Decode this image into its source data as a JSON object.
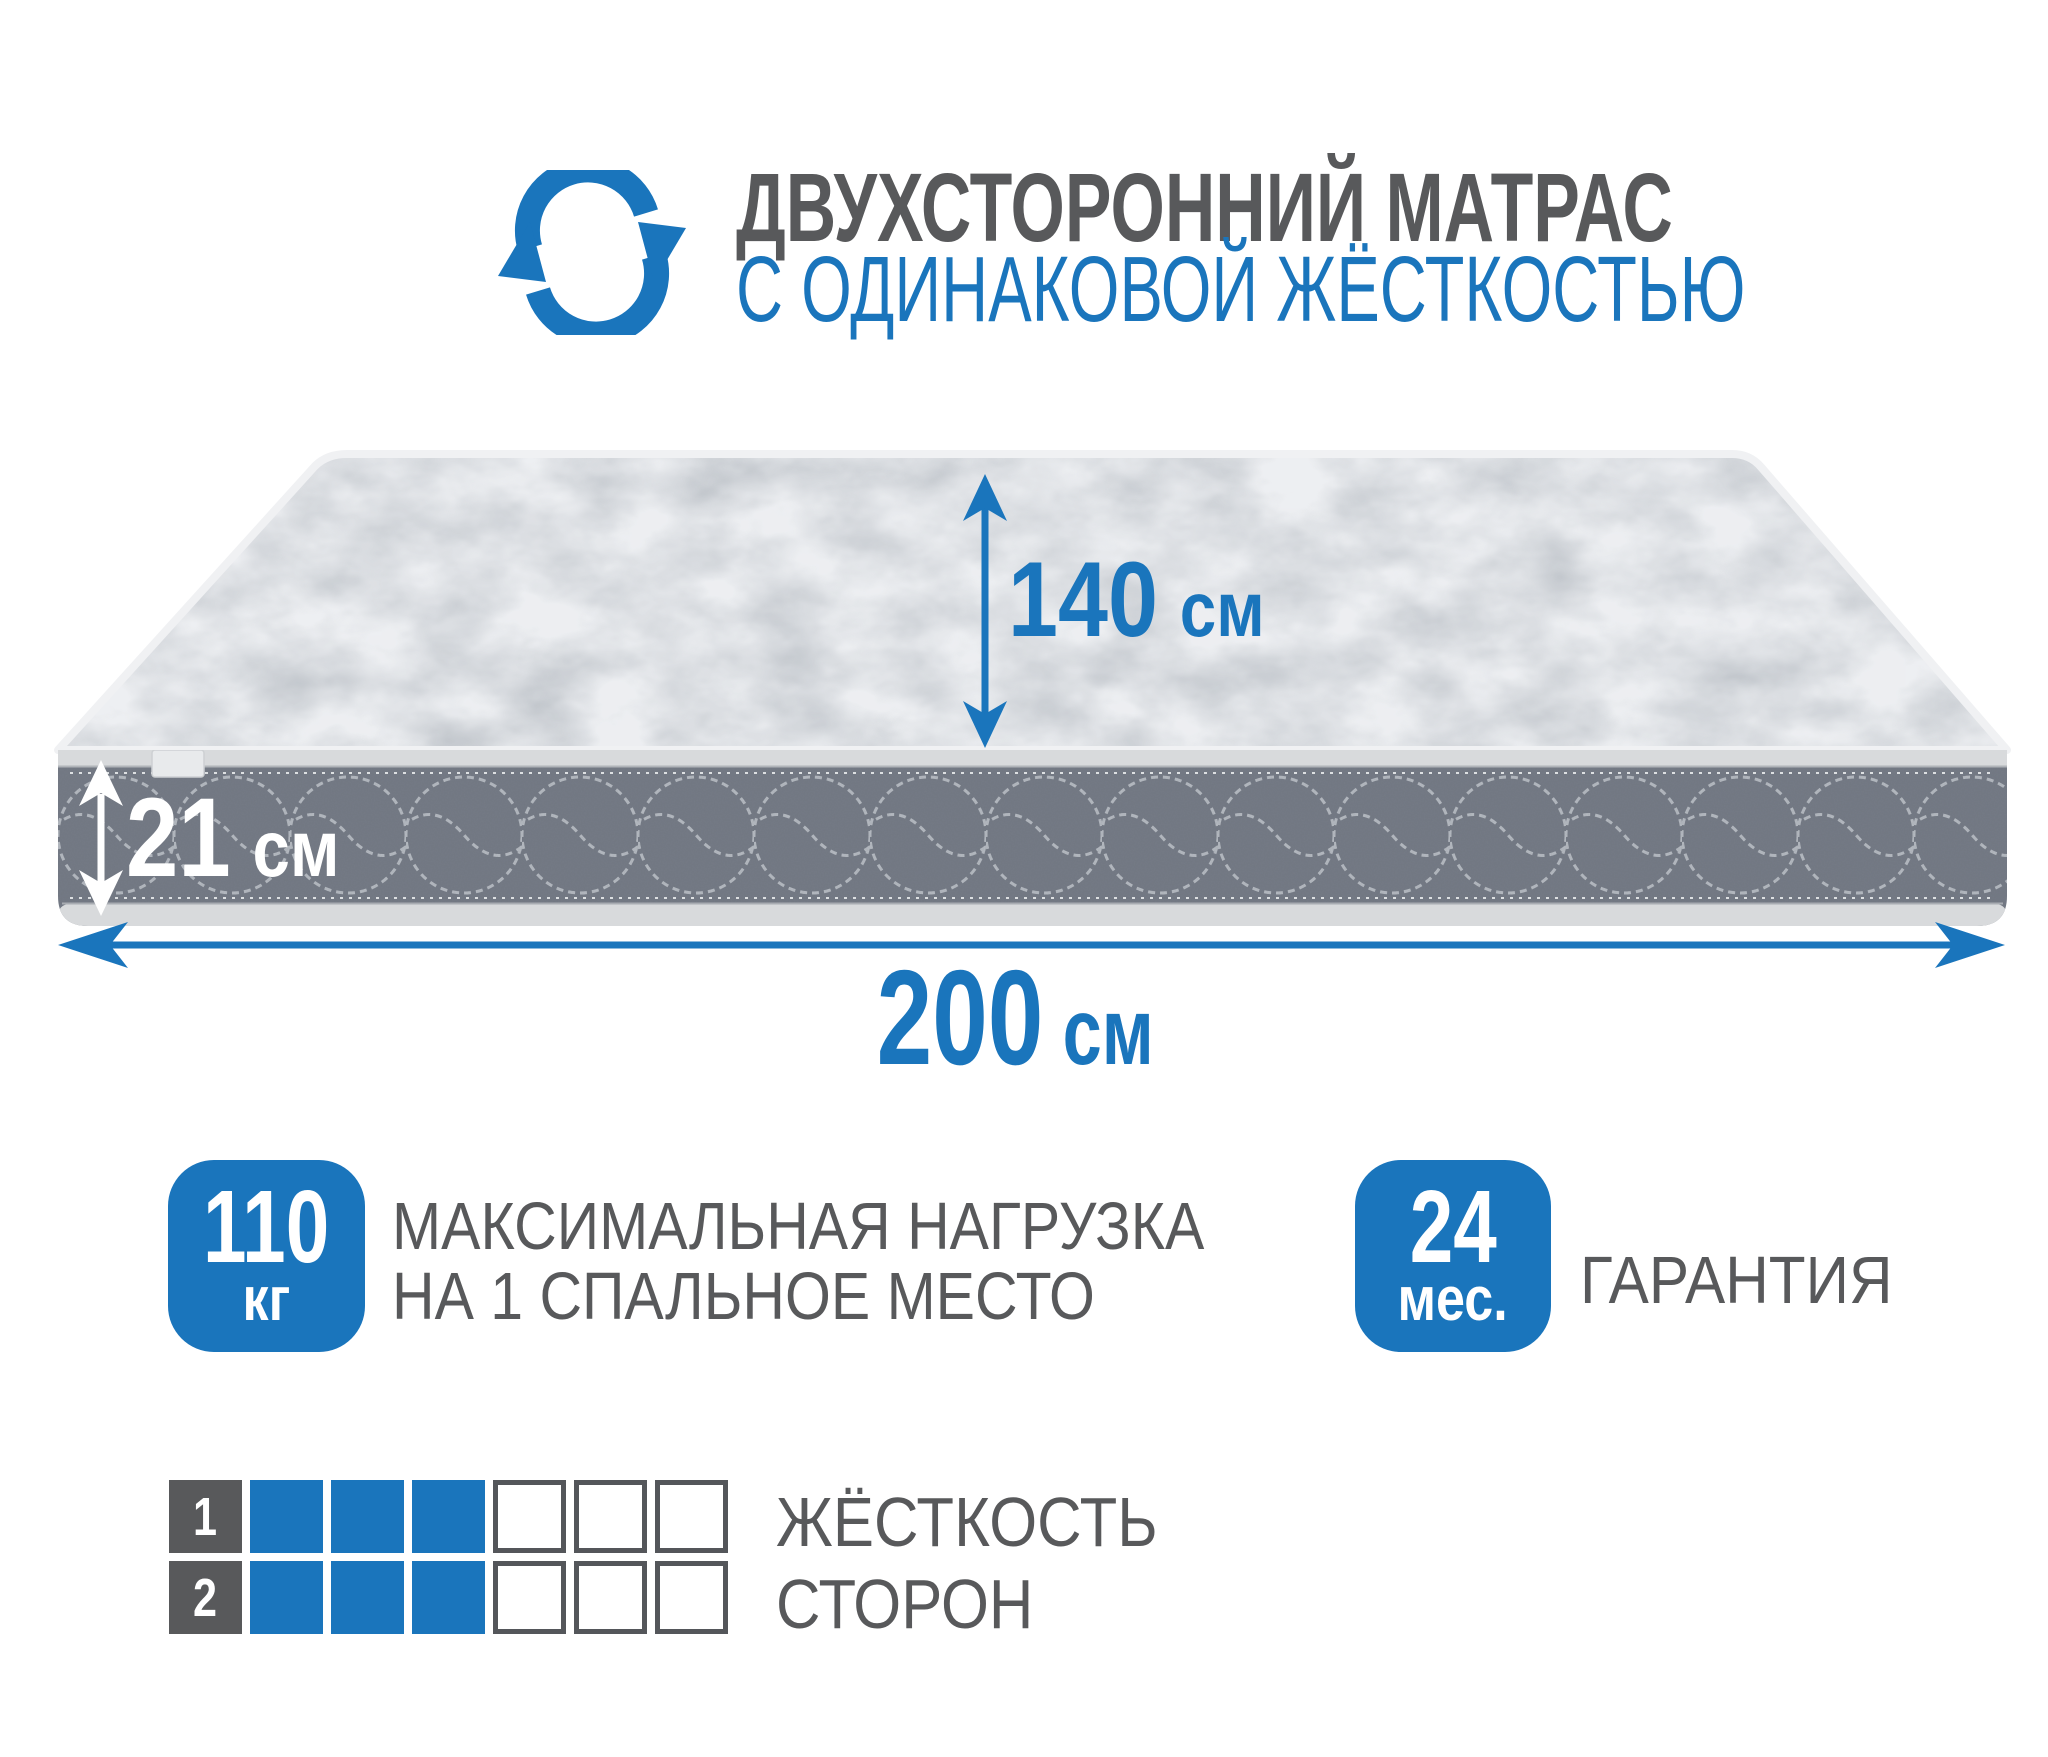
{
  "header": {
    "line1": "ДВУХСТОРОННИЙ МАТРАС",
    "line2": "С ОДИНАКОВОЙ ЖЁСТКОСТЬЮ",
    "icon": "rotate-arrows-icon"
  },
  "dims": {
    "width": {
      "value": "140",
      "unit": "см"
    },
    "height": {
      "value": "21",
      "unit": "см"
    },
    "length": {
      "value": "200",
      "unit": "см"
    }
  },
  "load": {
    "value": "110",
    "unit": "кг",
    "caption_line1": "МАКСИМАЛЬНАЯ НАГРУЗКА",
    "caption_line2": "НА 1 СПАЛЬНОЕ МЕСТО"
  },
  "warranty": {
    "value": "24",
    "unit": "мес.",
    "caption": "ГАРАНТИЯ"
  },
  "firmness": {
    "caption_line1": "ЖЁСТКОСТЬ",
    "caption_line2": "СТОРОН",
    "scale_total": 6,
    "rows": [
      {
        "label": "1",
        "filled": 3
      },
      {
        "label": "2",
        "filled": 3
      }
    ]
  },
  "colors": {
    "accent": "#1a75bc",
    "text_gray": "#58595b"
  }
}
